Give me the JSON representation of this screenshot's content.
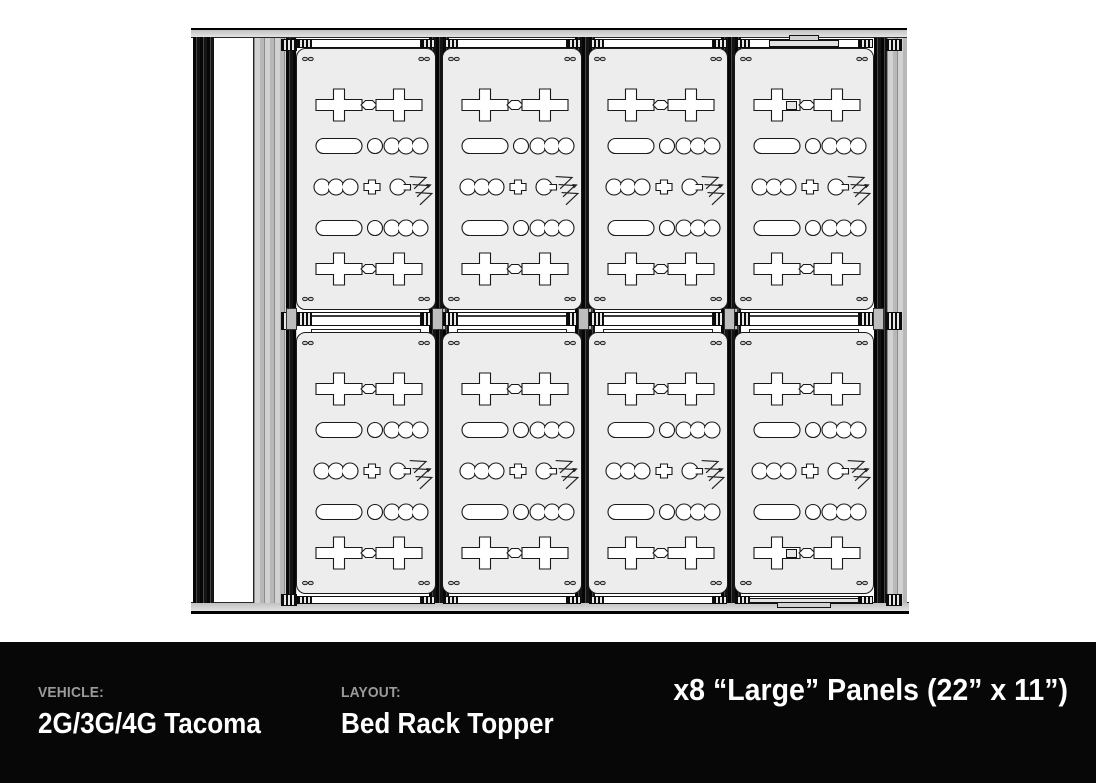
{
  "footer": {
    "vehicle_label": "VEHICLE:",
    "vehicle_value": "2G/3G/4G Tacoma",
    "layout_label": "LAYOUT:",
    "layout_value": "Bed Rack Topper",
    "headline": "x8 “Large” Panels (22” x 11”)"
  },
  "diagram": {
    "panel_count": 8,
    "grid_rows": 2,
    "grid_columns": 4
  },
  "colors": {
    "footer_background": "#070707",
    "label_gray": "#9b9b9b",
    "value_white": "#ffffff",
    "panel_fill": "#ededed",
    "outline": "#1a1a1a",
    "rail_gray": "#c6c6c6"
  }
}
